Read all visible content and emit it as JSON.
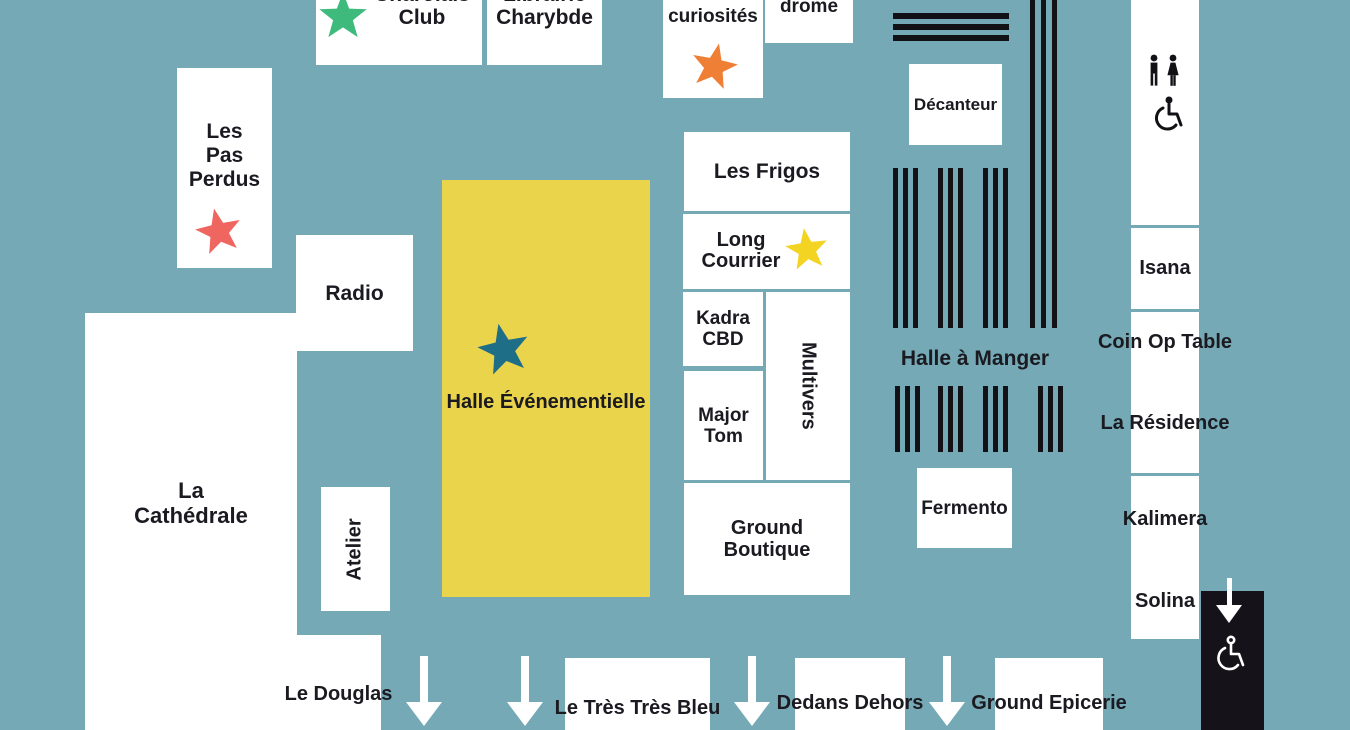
{
  "title": "venue-floor-map",
  "colors": {
    "background": "#74a9b5",
    "box_white": "#ffffff",
    "text": "#1a1a20",
    "stripe_black": "#111116",
    "exit_block_black": "#15121a",
    "halle_evenementielle_yellow": "#e9d44b",
    "star_green": "#3fba7d",
    "star_orange": "#ee7f35",
    "star_red": "#ef6661",
    "star_yellow": "#f3d423",
    "star_teal": "#1e6e88",
    "arrow_white": "#ffffff"
  },
  "venues": {
    "charolais_club": "Charolais\nClub",
    "librairie_charybde": "Librairie\nCharybde",
    "cabinet_curiosites": "des\ncuriosités",
    "velodrome": "drome",
    "decanteur": "Décanteur",
    "les_pas_perdus": "Les\nPas\nPerdus",
    "radio": "Radio",
    "halle_evenementielle": "Halle Événementielle",
    "les_frigos": "Les Frigos",
    "long_courrier": "Long\nCourrier",
    "kadra_cbd": "Kadra\nCBD",
    "multivers": "Multivers",
    "major_tom": "Major\nTom",
    "ground_boutique": "Ground\nBoutique",
    "halle_a_manger": "Halle à Manger",
    "fermento": "Fermento",
    "isana": "Isana",
    "coin_op_table": "Coin Op\nTable",
    "la_residence": "La\nRésidence",
    "kalimera": "Kalimera",
    "solina": "Solina",
    "la_cathedrale": "La\nCathédrale",
    "atelier": "Atelier",
    "le_douglas": "Le\nDouglas",
    "le_tres_tres_bleu": "Le Très\nTrès Bleu",
    "dedans_dehors": "Dedans\nDehors",
    "ground_epicerie": "Ground\nEpicerie"
  },
  "icons": {
    "restrooms": "mens-womens-restroom-icon",
    "accessible": "wheelchair-accessible-icon",
    "accessible_exit": "wheelchair-accessible-exit-icon",
    "entrance_arrows": "down-arrow-icon",
    "stars": [
      "green-star",
      "orange-star",
      "red-star",
      "yellow-star",
      "teal-star"
    ]
  }
}
